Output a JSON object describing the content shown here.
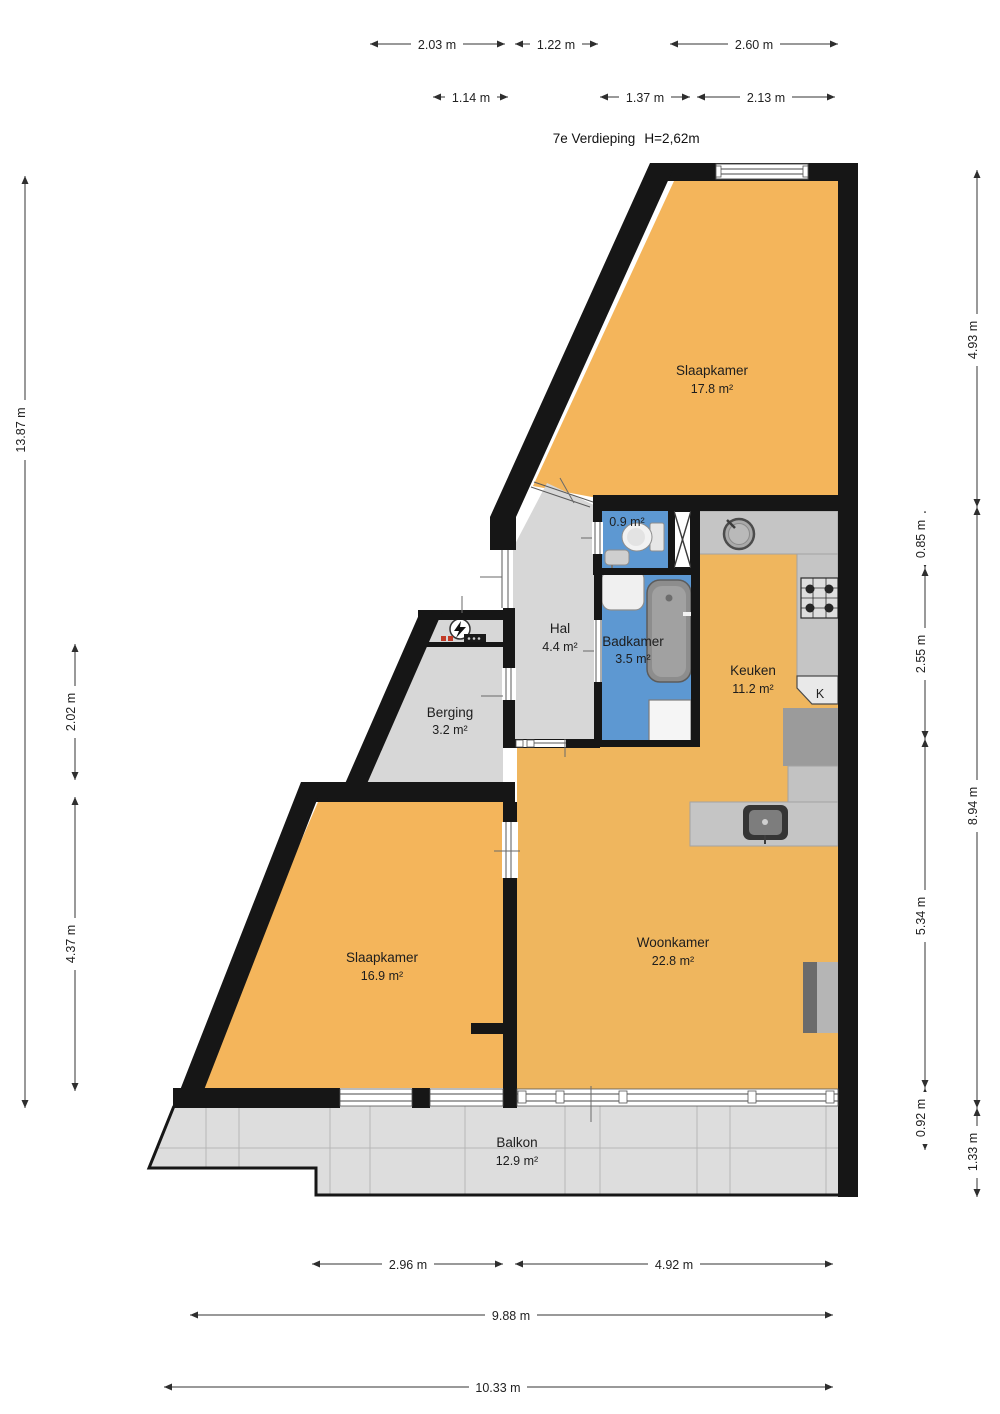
{
  "title": {
    "floor": "7e Verdieping",
    "ceiling": "H=2,62m"
  },
  "rooms": {
    "slaapkamer1": {
      "name": "Slaapkamer",
      "area": "17.8 m²"
    },
    "toilet": {
      "area": "0.9 m²"
    },
    "badkamer": {
      "name": "Badkamer",
      "area": "3.5 m²"
    },
    "keuken": {
      "name": "Keuken",
      "area": "11.2 m²"
    },
    "hal": {
      "name": "Hal",
      "area": "4.4 m²"
    },
    "berging": {
      "name": "Berging",
      "area": "3.2 m²"
    },
    "slaapkamer2": {
      "name": "Slaapkamer",
      "area": "16.9 m²"
    },
    "woonkamer": {
      "name": "Woonkamer",
      "area": "22.8 m²"
    },
    "balkon": {
      "name": "Balkon",
      "area": "12.9 m²"
    },
    "kast": {
      "label": "K"
    }
  },
  "dimensions": {
    "top_row1": [
      "2.03 m",
      "1.22 m",
      "2.60 m"
    ],
    "top_row2": [
      "1.14 m",
      "1.37 m",
      "2.13 m"
    ],
    "left_outer": [
      "13.87 m"
    ],
    "left_inner": [
      "2.02 m",
      "4.37 m"
    ],
    "right_outer": [
      "4.93 m",
      "8.94 m",
      "1.33 m"
    ],
    "right_inner": [
      "0.85 m",
      "2.55 m",
      "5.34 m",
      "0.92 m"
    ],
    "bottom": [
      "2.96 m",
      "4.92 m",
      "9.88 m",
      "10.33 m"
    ]
  },
  "colors": {
    "room_orange": "#F4B55B",
    "living_orange": "#EFB65E",
    "wet_blue": "#5D98D2",
    "floor_gray": "#D7D7D7",
    "balcony_gray": "#DDDDDD",
    "counter_gray": "#C5C5C5",
    "wall_black": "#161616"
  }
}
